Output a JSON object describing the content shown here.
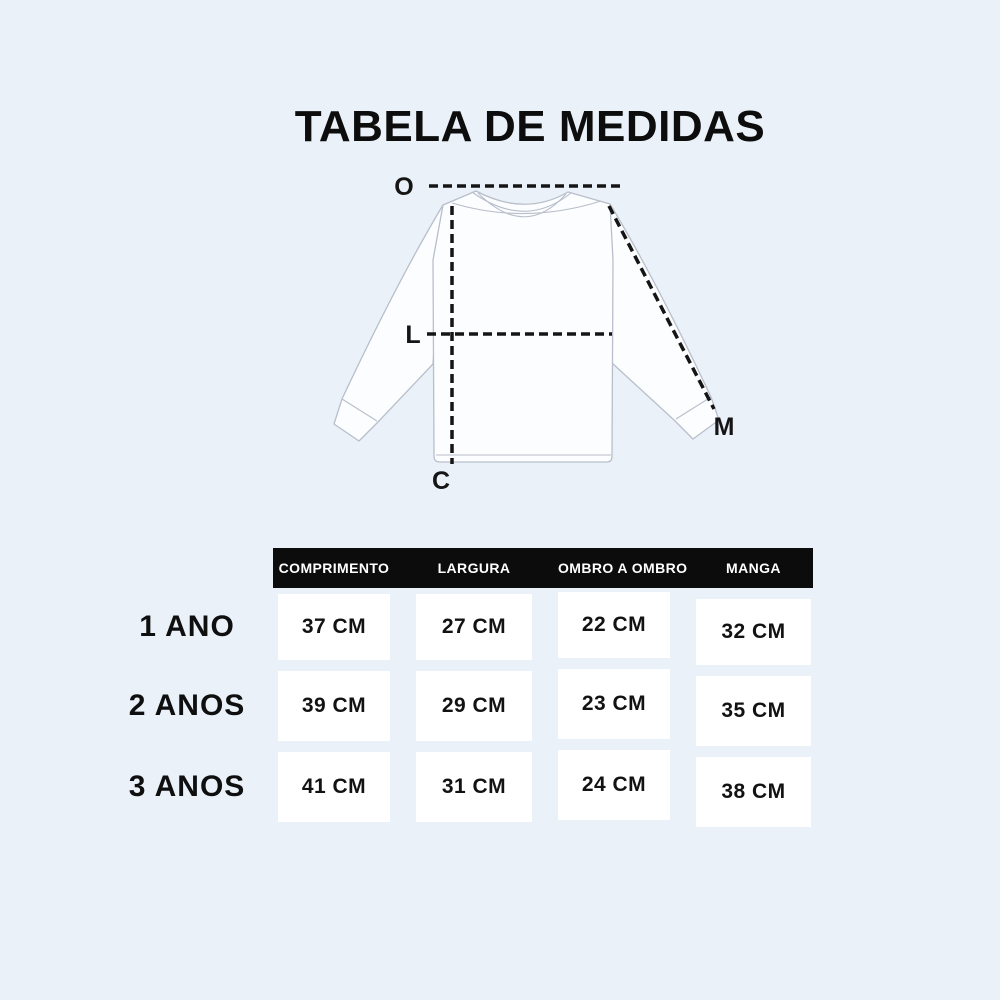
{
  "title": "TABELA DE MEDIDAS",
  "colors": {
    "background": "#EAF1F9",
    "header_bg": "#0C0C0C",
    "header_text": "#FFFFFF",
    "cell_bg": "#FFFFFF",
    "text": "#0F0F0F",
    "shirt_outline": "#B8BFCB",
    "shirt_fill": "#FCFDFE",
    "measure_line": "#151515"
  },
  "diagram": {
    "labels": {
      "shoulder": "O",
      "width": "L",
      "length": "C",
      "sleeve": "M"
    }
  },
  "table": {
    "columns": [
      "COMPRIMENTO",
      "LARGURA",
      "OMBRO A OMBRO",
      "MANGA"
    ],
    "rows": [
      {
        "label": "1 ANO",
        "values": [
          "37 CM",
          "27 CM",
          "22 CM",
          "32 CM"
        ]
      },
      {
        "label": "2 ANOS",
        "values": [
          "39 CM",
          "29 CM",
          "23 CM",
          "35 CM"
        ]
      },
      {
        "label": "3 ANOS",
        "values": [
          "41 CM",
          "31 CM",
          "24 CM",
          "38 CM"
        ]
      }
    ]
  }
}
